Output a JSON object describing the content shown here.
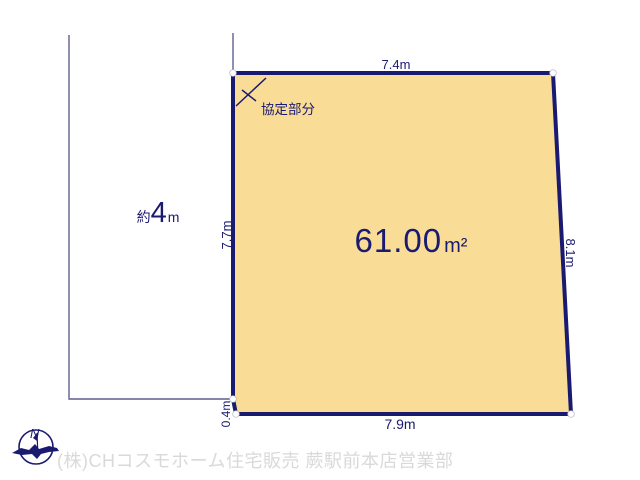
{
  "plot": {
    "area": {
      "value": "61.00",
      "unit": "m²"
    },
    "edges": {
      "top": "7.4m",
      "right": "8.1m",
      "bottom": "7.9m",
      "left": "7.7m",
      "left_offset": "0.4m"
    },
    "agreement_label": "協定部分"
  },
  "road": {
    "approx_prefix": "約",
    "width_value": "4",
    "width_unit": "m"
  },
  "compass": {
    "north": "N"
  },
  "footer": {
    "company_line": "(株)CHコスモホーム住宅販売 蕨駅前本店営業部"
  },
  "colors": {
    "plot_fill": "#f9dc96",
    "outline_navy": "#1a1a70",
    "boundary_thin": "#5f5f90",
    "footer_gray": "#d9d9d9"
  }
}
